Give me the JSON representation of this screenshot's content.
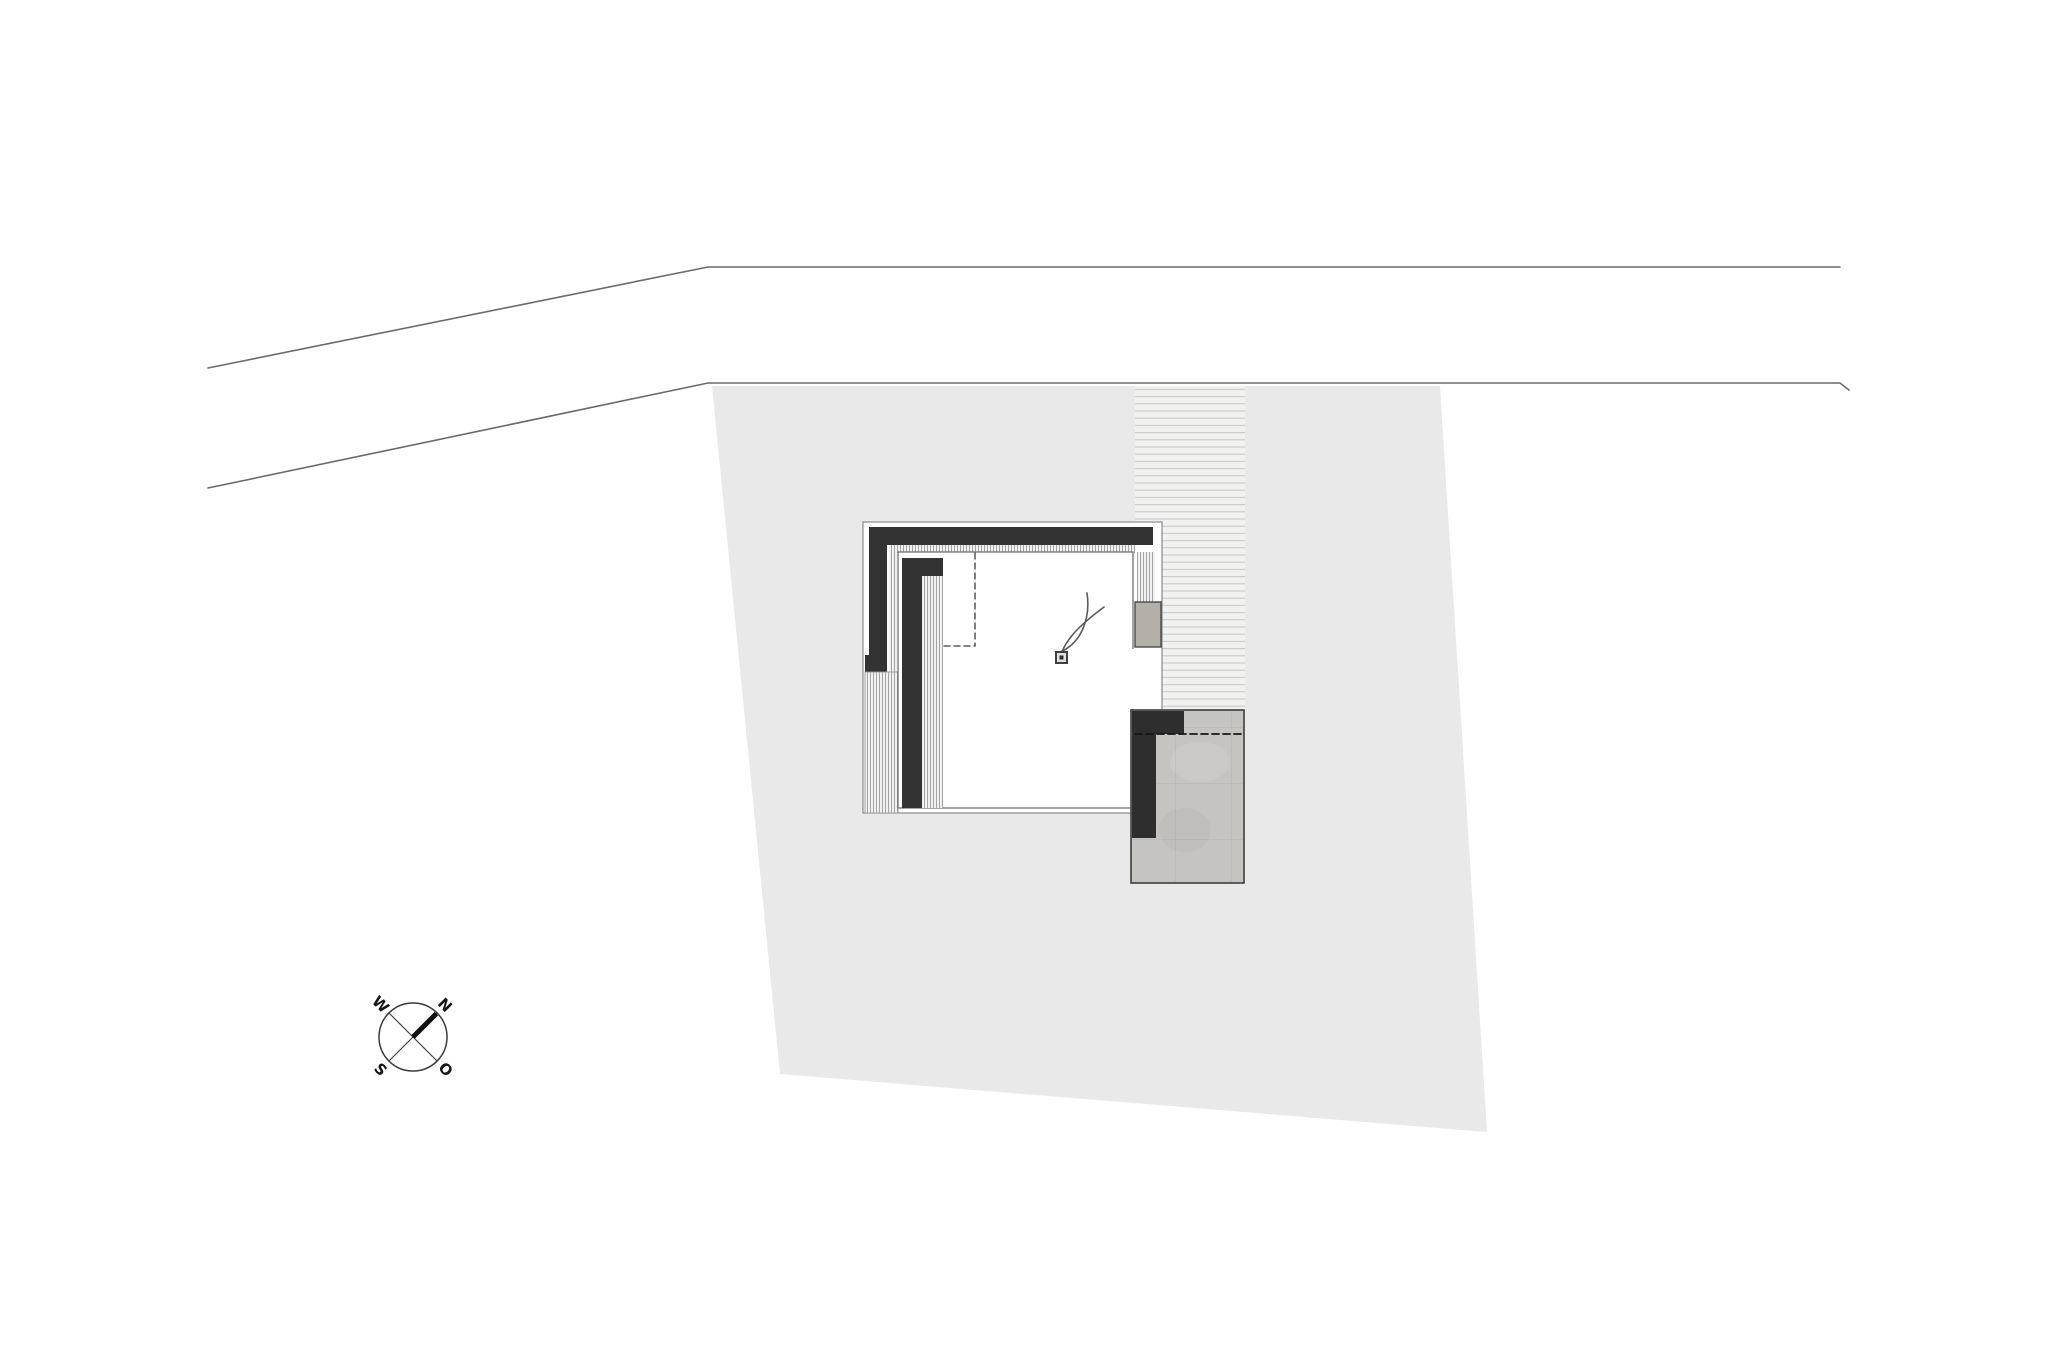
{
  "page": {
    "title": "Site plan drawing",
    "width": 2048,
    "height": 1365,
    "background": "#ffffff"
  },
  "colors": {
    "paper": "#ffffff",
    "parcel_fill": "#e9e9e9",
    "road_line": "#6a6a6a",
    "wall_dark": "#333333",
    "terrace_wall_dark": "#2e2e2e",
    "roof_outline": "#8a8a8a",
    "room_outline": "#666666",
    "deck_stripe": "#9c9c9c",
    "deck_bg": "#f1f1f1",
    "hatch_line": "#c9c9c9",
    "hatch_bg": "#f1f1f0",
    "concrete_fill": "#c6c4c0",
    "concrete_joint": "#bbb9b5",
    "concrete_block_fill": "#b4afa7",
    "dashed_line": "#3a3a3a",
    "compass_line": "#3a3a3a",
    "compass_needle": "#111111",
    "plant_stroke": "#5a5a5a"
  },
  "site_plan": {
    "patterns": [
      {
        "id": "stripesV",
        "w": 3,
        "h": 8,
        "bg": "#f1f1f1",
        "lines": [
          {
            "x1": 0.5,
            "y1": 0,
            "x2": 0.5,
            "y2": 8,
            "stroke": "#9c9c9c",
            "sw": 0.9
          }
        ]
      },
      {
        "id": "hatchH",
        "w": 12,
        "h": 7.2,
        "bg": "#f1f1f0",
        "lines": [
          {
            "x1": 0,
            "y1": 0.6,
            "x2": 12,
            "y2": 0.6,
            "stroke": "#c9c9c9",
            "sw": 1.1
          }
        ]
      },
      {
        "id": "concrete",
        "w": 56,
        "h": 56,
        "bg": "#c6c4c0",
        "lines": [
          {
            "x1": 0,
            "y1": 55.5,
            "x2": 56,
            "y2": 55.5,
            "stroke": "#bbb9b5",
            "sw": 0.8
          },
          {
            "x1": 55.5,
            "y1": 0,
            "x2": 55.5,
            "y2": 56,
            "stroke": "#bbb9b5",
            "sw": 0.8
          }
        ]
      }
    ],
    "shapes": [
      {
        "name": "road-edge-upper",
        "type": "polyline",
        "points": "208,368 708,267 1840,267",
        "stroke": "#6a6a6a",
        "sw": 1.6
      },
      {
        "name": "road-edge-lower",
        "type": "polyline",
        "points": "208,488 708,383 1840,383 1849,390",
        "stroke": "#6a6a6a",
        "sw": 1.6
      },
      {
        "name": "site-parcel",
        "type": "polygon",
        "points": "712,386 1440,386 1487,1132 780,1074",
        "fill": "#e9e9e9"
      },
      {
        "name": "driveway-hatch",
        "type": "rect",
        "x": 1135,
        "y": 386,
        "w": 110,
        "h": 325,
        "fill": "url(#hatchH)"
      },
      {
        "name": "roof-outline",
        "type": "rect",
        "x": 863,
        "y": 522,
        "w": 299,
        "h": 291,
        "fill": "#ffffff",
        "stroke": "#8a8a8a",
        "sw": 1.2
      },
      {
        "name": "parapet-wall-top",
        "type": "rect",
        "x": 869,
        "y": 527,
        "w": 284,
        "h": 18,
        "fill": "#333333"
      },
      {
        "name": "parapet-wall-left",
        "type": "rect",
        "x": 869,
        "y": 527,
        "w": 18,
        "h": 128,
        "fill": "#333333"
      },
      {
        "name": "parapet-end-block",
        "type": "rect",
        "x": 865,
        "y": 655,
        "w": 22,
        "h": 17,
        "fill": "#333333"
      },
      {
        "name": "deck-strip-top",
        "type": "rect",
        "x": 889,
        "y": 545,
        "w": 246,
        "h": 8,
        "fill": "url(#stripesV)"
      },
      {
        "name": "deck-strip-left",
        "type": "rect",
        "x": 889,
        "y": 553,
        "w": 8,
        "h": 119,
        "fill": "url(#stripesV)"
      },
      {
        "name": "deck-strip-right",
        "type": "rect",
        "x": 1137,
        "y": 552,
        "w": 18,
        "h": 50,
        "fill": "url(#stripesV)"
      },
      {
        "name": "deck-column-left",
        "type": "rect",
        "x": 865,
        "y": 672,
        "w": 33,
        "h": 141,
        "fill": "url(#stripesV)",
        "stroke": "#999999",
        "sw": 0.9
      },
      {
        "name": "room",
        "type": "rect",
        "x": 898,
        "y": 552,
        "w": 235,
        "h": 256,
        "fill": "#ffffff",
        "stroke": "#666666",
        "sw": 1.2
      },
      {
        "name": "room-wall-stub",
        "type": "rect",
        "x": 902,
        "y": 558,
        "w": 41,
        "h": 18,
        "fill": "#333333"
      },
      {
        "name": "room-wall-left",
        "type": "rect",
        "x": 902,
        "y": 558,
        "w": 20,
        "h": 250,
        "fill": "#333333"
      },
      {
        "name": "room-floor-strip",
        "type": "rect",
        "x": 922,
        "y": 576,
        "w": 21,
        "h": 232,
        "fill": "url(#stripesV)"
      },
      {
        "name": "glass-opening",
        "type": "rect",
        "x": 1132,
        "y": 649,
        "w": 29,
        "h": 60,
        "fill": "#ffffff"
      },
      {
        "name": "closet-dashed-vertical",
        "type": "line",
        "x1": 975,
        "y1": 553,
        "x2": 975,
        "y2": 646,
        "stroke": "#3a3a3a",
        "sw": 1.3,
        "dash": "6 4"
      },
      {
        "name": "closet-dashed-horizontal",
        "type": "line",
        "x1": 944,
        "y1": 646,
        "x2": 975,
        "y2": 646,
        "stroke": "#3a3a3a",
        "sw": 1.3,
        "dash": "6 4"
      },
      {
        "name": "concrete-block",
        "type": "rect",
        "x": 1135,
        "y": 602,
        "w": 26,
        "h": 45,
        "fill": "#b4afa7",
        "stroke": "#4a4a4a",
        "sw": 1.4
      },
      {
        "name": "plant-stem-1",
        "type": "path",
        "d": "M 1062 652 C 1068 636, 1084 622, 1104 607",
        "stroke": "#5a5a5a",
        "sw": 1.6
      },
      {
        "name": "plant-stem-2",
        "type": "path",
        "d": "M 1060 652 C 1080 644, 1091 620, 1087 593",
        "stroke": "#5a5a5a",
        "sw": 1.6
      },
      {
        "name": "column-marker",
        "type": "rect",
        "x": 1056,
        "y": 652,
        "w": 11,
        "h": 11,
        "fill": "#e0e0e0",
        "stroke": "#3f3f3f",
        "sw": 2
      },
      {
        "name": "column-marker-dot",
        "type": "rect",
        "x": 1059.5,
        "y": 655.5,
        "w": 4,
        "h": 4,
        "fill": "#2f2f2f"
      },
      {
        "name": "terrace-base",
        "type": "rect",
        "x": 1131,
        "y": 710,
        "w": 113,
        "h": 173,
        "fill": "url(#concrete)",
        "stroke": "#3e3e3e",
        "sw": 1.6
      },
      {
        "name": "terrace-mottle-1",
        "type": "ellipse",
        "cx": 1200,
        "cy": 762,
        "rx": 30,
        "ry": 20,
        "fill": "rgba(255,255,255,0.10)"
      },
      {
        "name": "terrace-mottle-2",
        "type": "ellipse",
        "cx": 1185,
        "cy": 830,
        "rx": 26,
        "ry": 22,
        "fill": "rgba(110,105,95,0.06)"
      },
      {
        "name": "terrace-wall-top",
        "type": "rect",
        "x": 1132,
        "y": 711,
        "w": 52,
        "h": 23,
        "fill": "#2e2e2e"
      },
      {
        "name": "terrace-wall-left",
        "type": "rect",
        "x": 1132,
        "y": 711,
        "w": 24,
        "h": 127,
        "fill": "#2e2e2e"
      },
      {
        "name": "terrace-dashed-edge",
        "type": "line",
        "x1": 1135,
        "y1": 734,
        "x2": 1242,
        "y2": 734,
        "stroke": "#161616",
        "sw": 1.8,
        "dash": "7 4"
      }
    ],
    "compass": {
      "cx": 413,
      "cy": 1037,
      "r": 34,
      "rotation_deg": 45,
      "ring_color": "#3a3a3a",
      "needle_color": "#111111",
      "label_color": "#161616",
      "labels": {
        "north": "N",
        "east": "O",
        "south": "S",
        "west": "W"
      }
    }
  }
}
